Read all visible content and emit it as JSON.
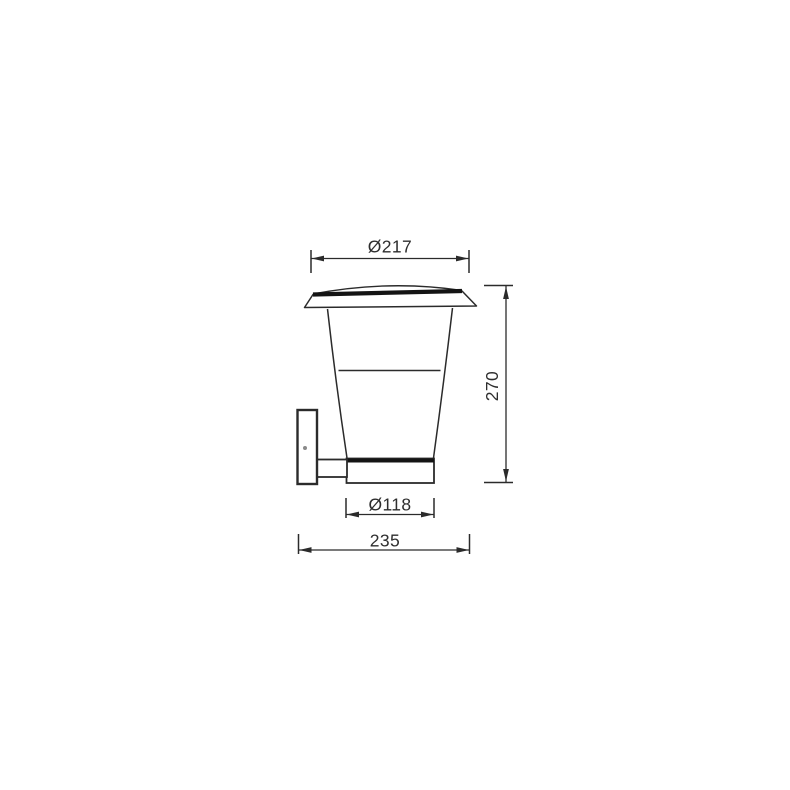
{
  "canvas": {
    "background": "#ffffff",
    "line_color": "#2b2b2b",
    "band_color": "#141414",
    "screw_color": "#8a8a8a"
  },
  "dimensions": {
    "top_diameter": "Ø217",
    "height": "270",
    "base_diameter": "Ø118",
    "depth": "235"
  }
}
